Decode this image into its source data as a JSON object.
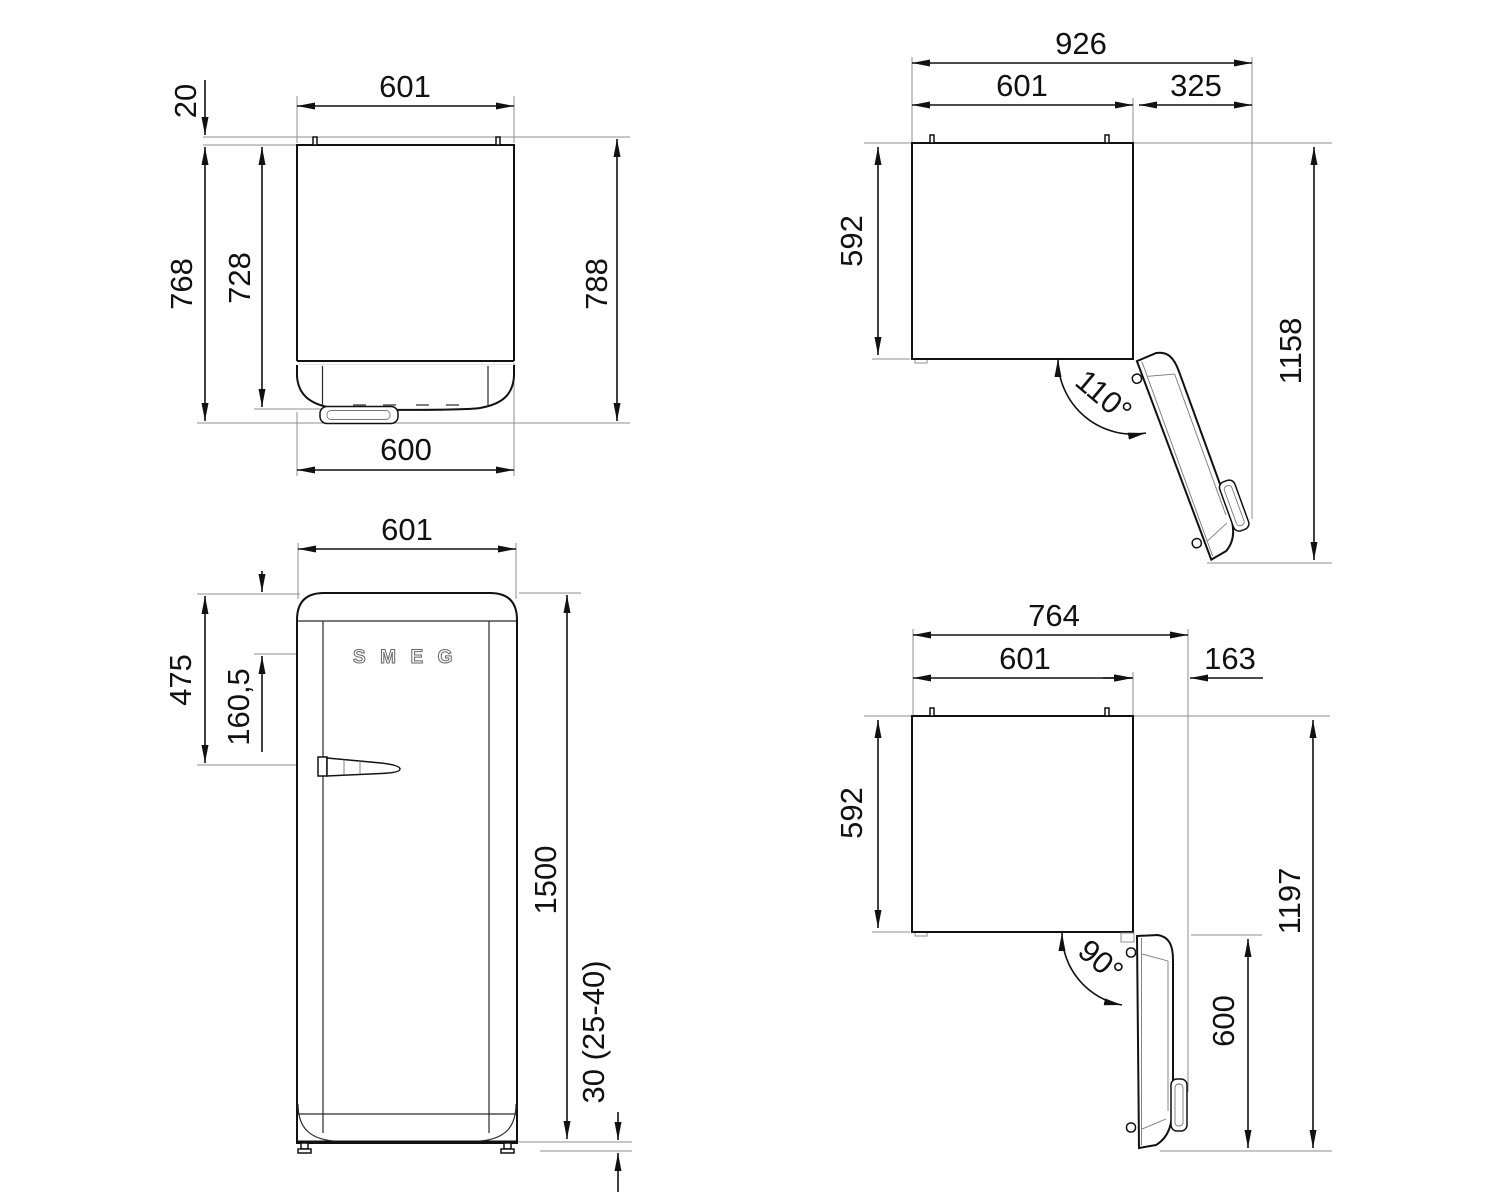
{
  "drawing": {
    "product_logo": "SMEG",
    "views": {
      "top_closed": {
        "top_width": "601",
        "rear_clearance": "20",
        "depth_to_handle": "768",
        "depth_to_door": "728",
        "total_depth": "788",
        "front_width": "600"
      },
      "top_open_110": {
        "total_width": "926",
        "body_width": "601",
        "door_projection": "325",
        "body_depth": "592",
        "total_depth": "1158",
        "opening_angle": "110°"
      },
      "front": {
        "width": "601",
        "handle_from_top": "475",
        "logo_from_top": "160,5",
        "height": "1500",
        "feet_height": "30 (25-40)",
        "logo_text": "SMEG"
      },
      "top_open_90": {
        "total_width": "764",
        "body_width": "601",
        "door_projection": "163",
        "body_depth": "592",
        "total_depth": "1197",
        "door_depth_open": "600",
        "opening_angle": "90°"
      }
    }
  }
}
